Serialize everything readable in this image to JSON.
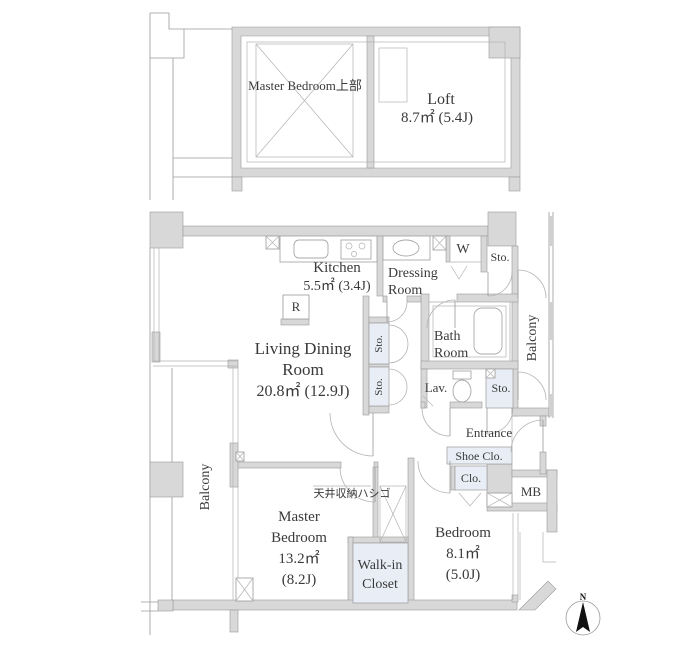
{
  "upper_plan": {
    "master_bedroom_above_label": "Master Bedroom上部",
    "loft_label": "Loft",
    "loft_area": "8.7㎡ (5.4J)"
  },
  "main_plan": {
    "kitchen_label": "Kitchen",
    "kitchen_area": "5.5㎡ (3.4J)",
    "refrigerator_label": "R",
    "dressing_line1": "Dressing",
    "dressing_line2": "Room",
    "washer_label": "W",
    "storage_label": "Sto.",
    "bath_line1": "Bath",
    "bath_line2": "Room",
    "lavatory_label": "Lav.",
    "living_line1": "Living Dining",
    "living_line2": "Room",
    "living_area": "20.8㎡ (12.9J)",
    "balcony_label": "Balcony",
    "entrance_label": "Entrance",
    "shoe_closet_label": "Shoe Clo.",
    "closet_label": "Clo.",
    "meter_box_label": "MB",
    "master_line1": "Master",
    "master_line2": "Bedroom",
    "master_area1": "13.2㎡",
    "master_area2": "(8.2J)",
    "ceiling_ladder_label": "天井収納ハシゴ",
    "wic_line1": "Walk-in",
    "wic_line2": "Closet",
    "bedroom_label": "Bedroom",
    "bedroom_area1": "8.1㎡",
    "bedroom_area2": "(5.0J)",
    "compass_north_label": "N"
  },
  "colors": {
    "wall_fill": "#d8d8d8",
    "closet_fill": "#e9eef6",
    "line": "#9a9a9a",
    "text": "#3a3a3a",
    "background": "#ffffff"
  }
}
